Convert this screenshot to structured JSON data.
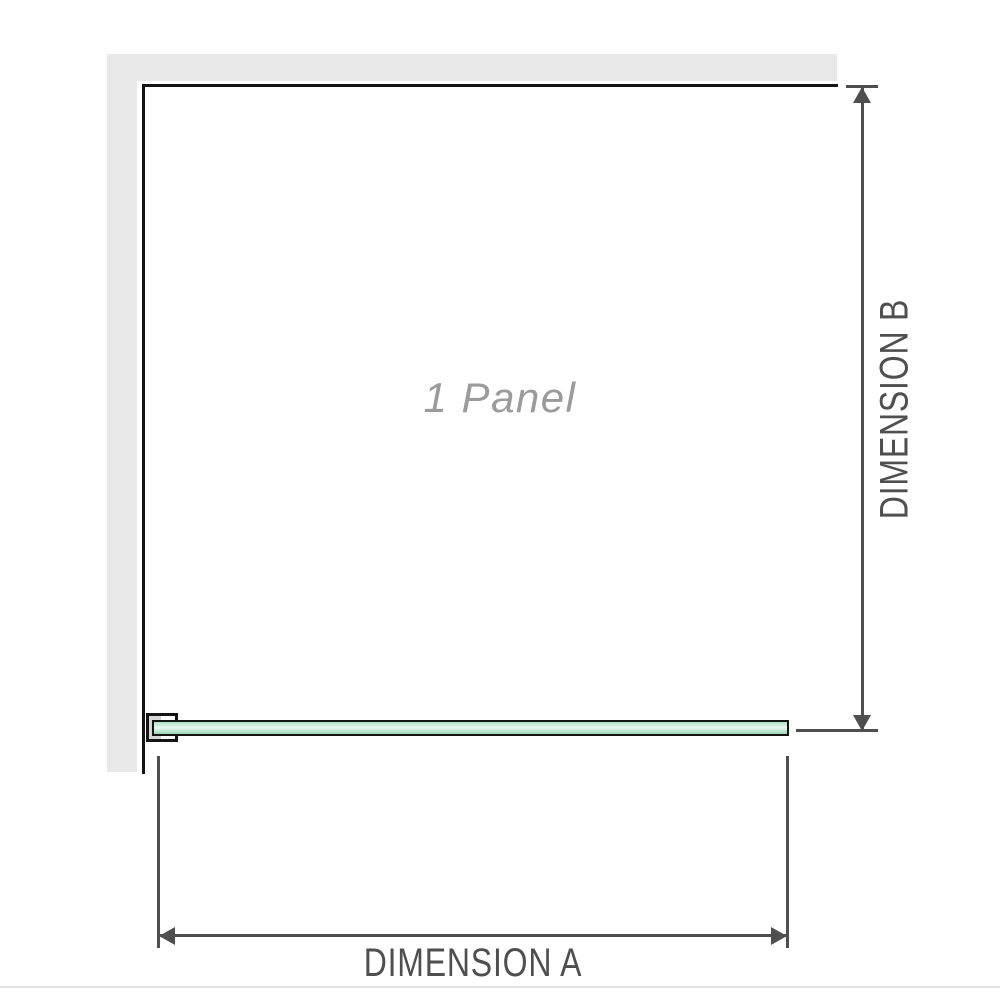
{
  "diagram": {
    "title": "1 panel shower screen installation diagram",
    "panel_label": "1 Panel",
    "dimension_a_label": "DIMENSION A",
    "dimension_b_label": "DIMENSION B",
    "panel_count": 1
  },
  "colors": {
    "wall": "#e8e8e8",
    "edge": "#141414",
    "dim": "#4f4f4f",
    "panelText": "#9b9b9b",
    "insert": "#d6d6d6",
    "glassTop": "#aee1c6",
    "glassMid": "#e9f8f0",
    "glassBottom": "#95d6b4",
    "footer": "#e3e3e3"
  }
}
